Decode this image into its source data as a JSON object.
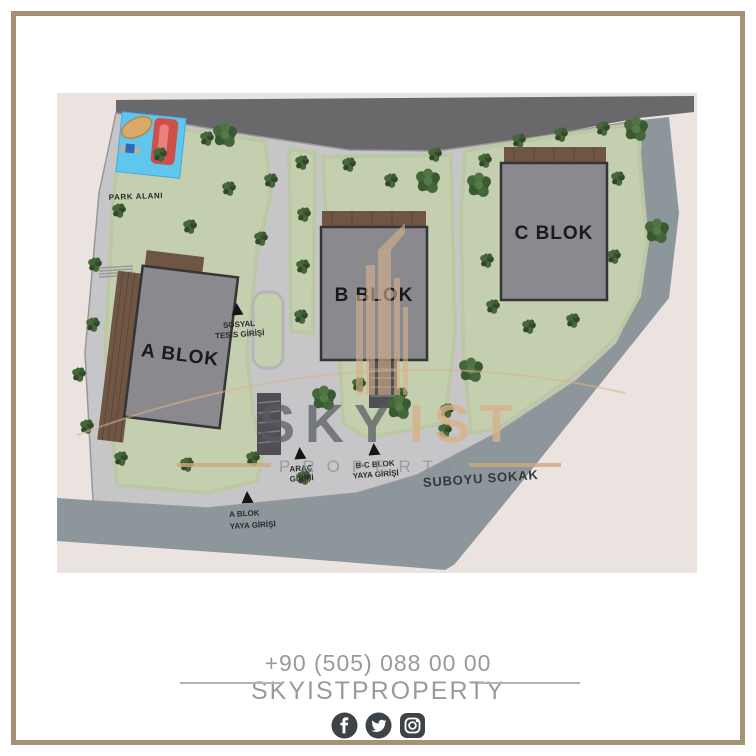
{
  "plan": {
    "park_area_label": "PARK ALANI",
    "blocks": {
      "a": "A BLOK",
      "b": "B BLOK",
      "c": "C BLOK"
    },
    "entrances": {
      "social_facility": {
        "line1": "SOSYAL",
        "line2": "TESİS GİRİŞİ"
      },
      "vehicle": {
        "line1": "ARAÇ",
        "line2": "GİRİŞİ"
      },
      "bc_pedestrian": {
        "line1": "B-C BLOK",
        "line2": "YAYA GİRİŞİ"
      },
      "a_pedestrian": {
        "line1": "A BLOK",
        "line2": "YAYA GİRİŞİ"
      }
    },
    "street_name": "SUBOYU SOKAK"
  },
  "watermark": {
    "brand_primary": "SKY",
    "brand_accent": "IST",
    "brand_secondary": "PROPERTY"
  },
  "footer": {
    "phone": "+90 (505) 088 00 00",
    "brand": "SKYISTPROPERTY",
    "social_icons": {
      "first": "facebook-icon",
      "second": "twitter-icon",
      "third": "instagram-icon"
    }
  },
  "colors": {
    "frame_border": "#a59175",
    "accent_tan": "#d9b28a",
    "lawn": "#c3cfae",
    "road_dark": "#69696b",
    "road_light": "#8d969a",
    "building": "#8a8a8e",
    "footer_text": "#9a9a9a",
    "icon_dark": "#3d4347",
    "playground_blue": "#5fc6ee",
    "slide_red": "#cf4f4b"
  }
}
